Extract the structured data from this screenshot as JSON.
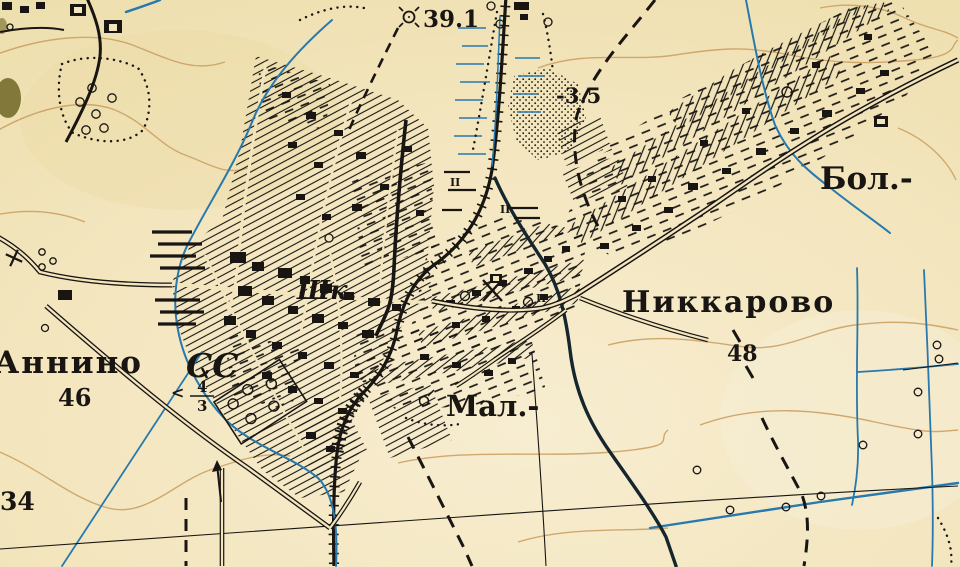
{
  "map": {
    "region_labels": {
      "bol": "Бол.-",
      "mal": "Мал.-",
      "nikkarovo": "Никкарово",
      "annino": "Аннино",
      "selsoviet": "СС",
      "school": "Шк."
    },
    "numbers": {
      "spot_height": "39.1",
      "depth_mark": "-3.5",
      "height_48": "48",
      "height_46": "46",
      "height_34": "34"
    },
    "road_sign": {
      "arrow": "<",
      "numerator": "4",
      "denominator": "3"
    },
    "meadow_mark": "II",
    "colors": {
      "paper": "#f2e4bb",
      "contours": "#cda468",
      "water": "#2779ae",
      "river_dark": "#15262e",
      "ink": "#181512",
      "vegetation_stain": "#6e6523"
    }
  }
}
